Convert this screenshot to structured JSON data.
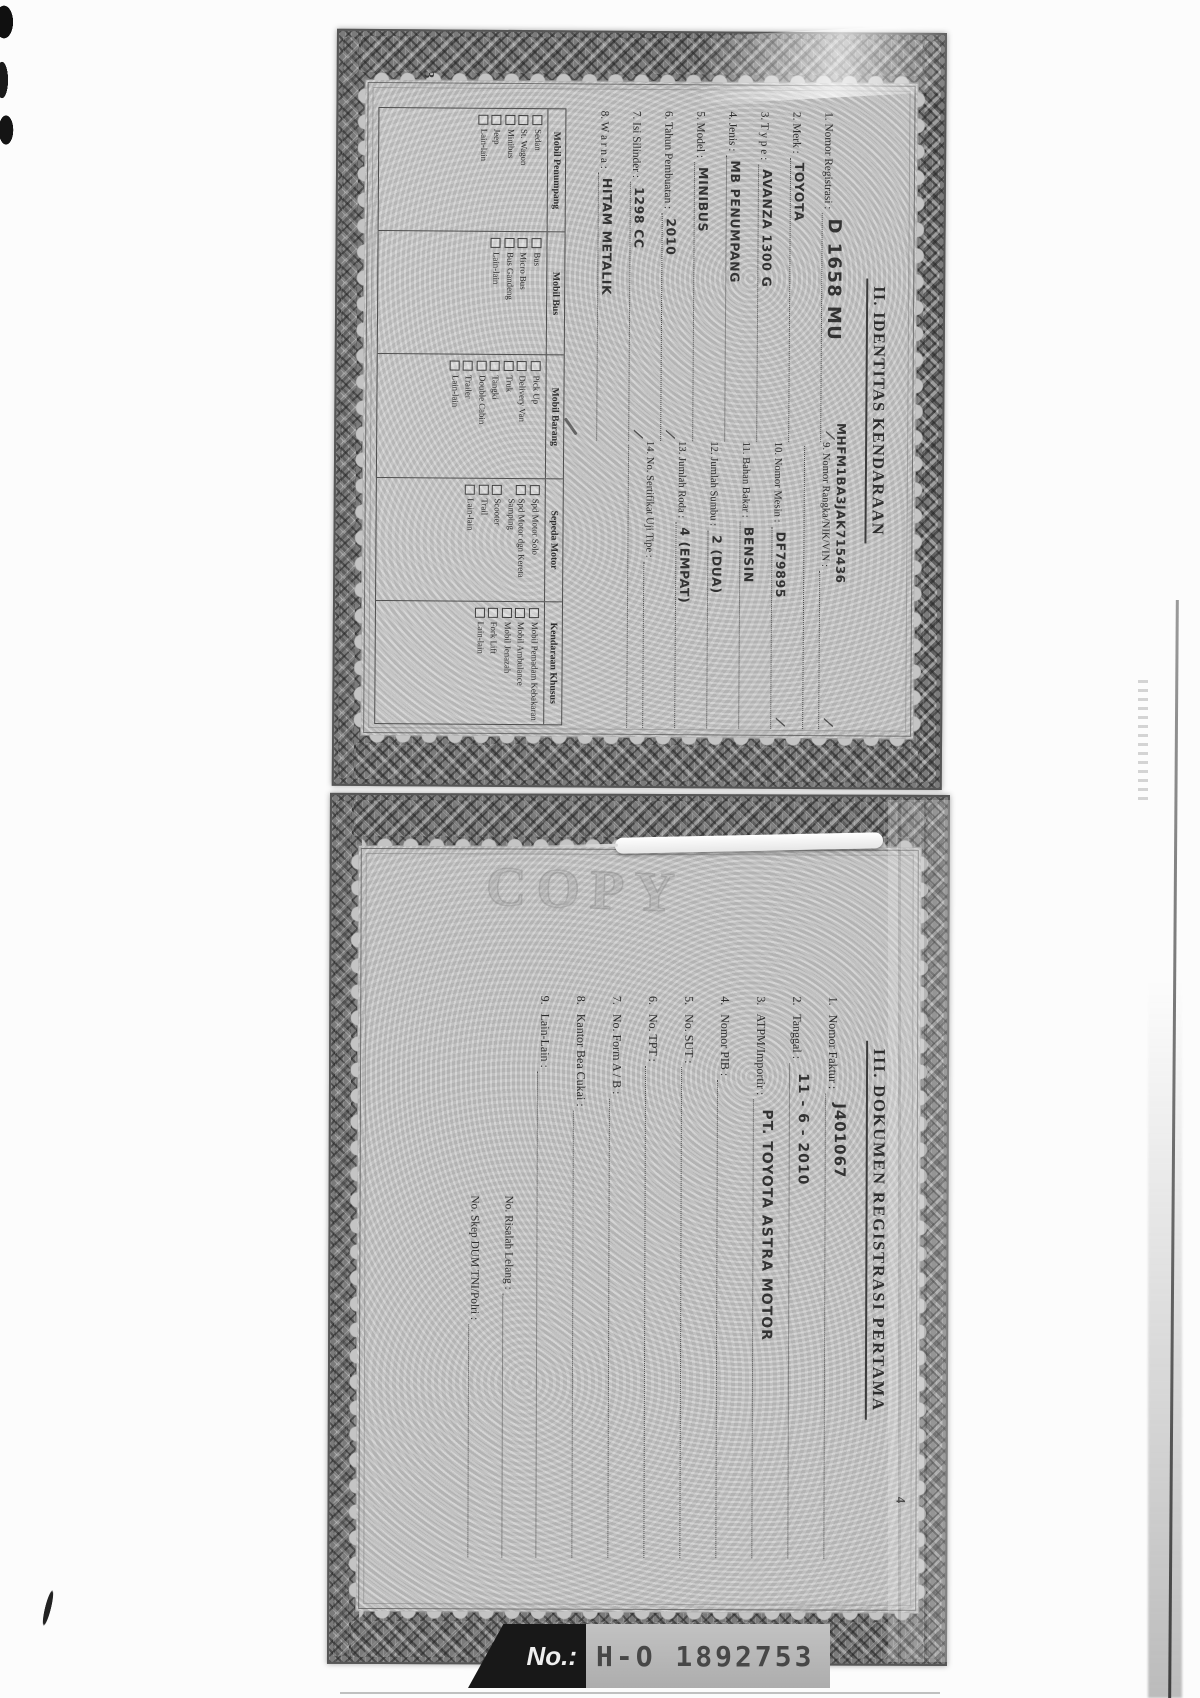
{
  "scan": {
    "watermark": "COPY",
    "tick_glyph": "/",
    "page1_number": "3",
    "page2_number": "4",
    "serial_label": "No.:",
    "serial_number": "H-O 1892753"
  },
  "page1": {
    "title": "II. IDENTITAS KENDARAAN",
    "fields_left": [
      {
        "label": "1. Nomor Registrasi :",
        "value": "D 1658 MU",
        "size": "big",
        "tick": true
      },
      {
        "label": "2. Merk :",
        "value": "TOYOTA"
      },
      {
        "label": "3. T y p e :",
        "value": "AVANZA 1300 G"
      },
      {
        "label": "4. Jenis :",
        "value": "MB PENUMPANG"
      },
      {
        "label": "5. Model :",
        "value": "MINIBUS"
      },
      {
        "label": "6. Tahun Pembuatan :",
        "value": "2010",
        "tick": true
      },
      {
        "label": "7. Isi Silinder :",
        "value": "1298 CC",
        "tick": true
      },
      {
        "label": "8. W a r n a :",
        "value": "HITAM METALIK"
      }
    ],
    "fields_right": [
      {
        "label": "9. Nomor Rangka/NIK/VIN :",
        "value": "MHFM1BA3JAK715436",
        "vin": true,
        "tick": true,
        "extra_line": true
      },
      {
        "label": "10. Nomor Mesin :",
        "value": "DF79895",
        "tick": true
      },
      {
        "label": "11. Bahan Bakar :",
        "value": "BENSIN"
      },
      {
        "label": "12. Jumlah Sumbu :",
        "value": "2 (DUA)"
      },
      {
        "label": "13. Jumlah Roda :",
        "value": "4 (EMPAT)"
      },
      {
        "label": "14. No. Sertifikat Uji Tipe :",
        "value": "",
        "extra_line": true
      }
    ],
    "vehicle_table": {
      "columns": [
        {
          "header": "Mobil Penumpang",
          "items": [
            "Sedan",
            "St. Wagon",
            "Minibus",
            "Jeep",
            "Lain-lain"
          ]
        },
        {
          "header": "Mobil Bus",
          "items": [
            "Bus",
            "Micro Bus",
            "Bus Gandeng",
            "Lain-lain"
          ]
        },
        {
          "header": "Mobil Barang",
          "items": [
            "Pick Up",
            "Delivery Van",
            "Truk",
            "Tangki",
            "Double Cabin",
            "Trailer",
            "Lain-lain"
          ]
        },
        {
          "header": "Sepeda Motor",
          "items": [
            "Spd Motor Solo",
            "Spd Motor dgn Kereta Samping",
            "Scooter",
            "Trail",
            "Lain-lain"
          ]
        },
        {
          "header": "Kendaraan Khusus",
          "items": [
            "Mobil Pemadam Kebakaran",
            "Mobil Ambulance",
            "Mobil Jenazah",
            "Fork Lift",
            "Lain-lain"
          ]
        }
      ]
    }
  },
  "page2": {
    "title": "III. DOKUMEN REGISTRASI PERTAMA",
    "fields": [
      {
        "label": "1.   Nomor Faktur :",
        "value": "J401067",
        "size": "big"
      },
      {
        "label": "2.   Tanggal :",
        "value": "11 - 6 - 2010"
      },
      {
        "label": "3.   ATPM/Importir :",
        "value": "PT. TOYOTA ASTRA MOTOR"
      },
      {
        "label": "4.   Nomor PIB :",
        "value": ""
      },
      {
        "label": "5.   No. SUT :",
        "value": ""
      },
      {
        "label": "6.   No. TPT :",
        "value": ""
      },
      {
        "label": "7.   No. Form A / B :",
        "value": ""
      },
      {
        "label": "8.   Kantor Bea Cukai :",
        "value": ""
      },
      {
        "label": "9.   Lain-Lain :",
        "value": ""
      }
    ],
    "sub_fields": [
      {
        "label": "No. Risalah Lelang :",
        "value": ""
      },
      {
        "label": "No. Skep DUM TNI/Polri :",
        "value": ""
      }
    ]
  }
}
